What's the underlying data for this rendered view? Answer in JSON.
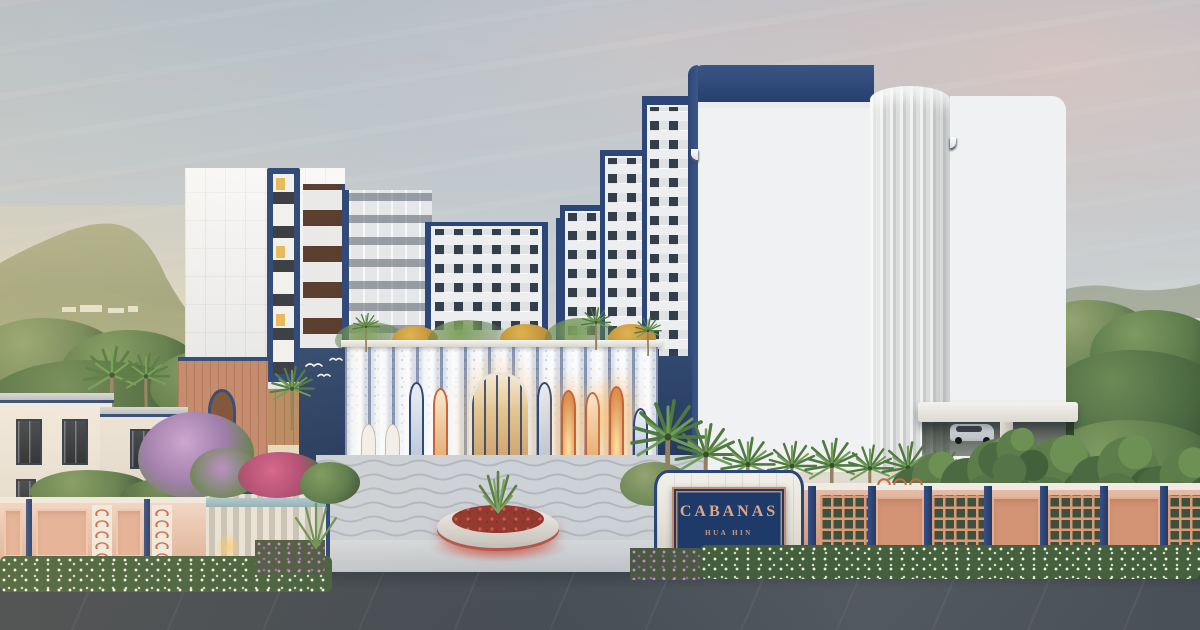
{
  "sign": {
    "project_name": "CABANAS",
    "location": "HUA HIN"
  },
  "palette": {
    "navy_trim": "#2b4677",
    "mosaic_blue": "#4a7ec2",
    "coral_accent": "#c9603c",
    "sign_letter_coral": "#dca687",
    "terracotta_wall": "#d99f80",
    "pink_wall": "#e9bfa8",
    "stone": "#e5e0d4",
    "plaza_gray": "#cdd2d7",
    "road_gray": "#474e55",
    "foliage_green": "#5d7d4b",
    "sky_gold": "#f4e3ab",
    "sky_pink": "#eac8bd",
    "led_red": "#d64040",
    "warm_window_light": "#ffcf8e"
  }
}
